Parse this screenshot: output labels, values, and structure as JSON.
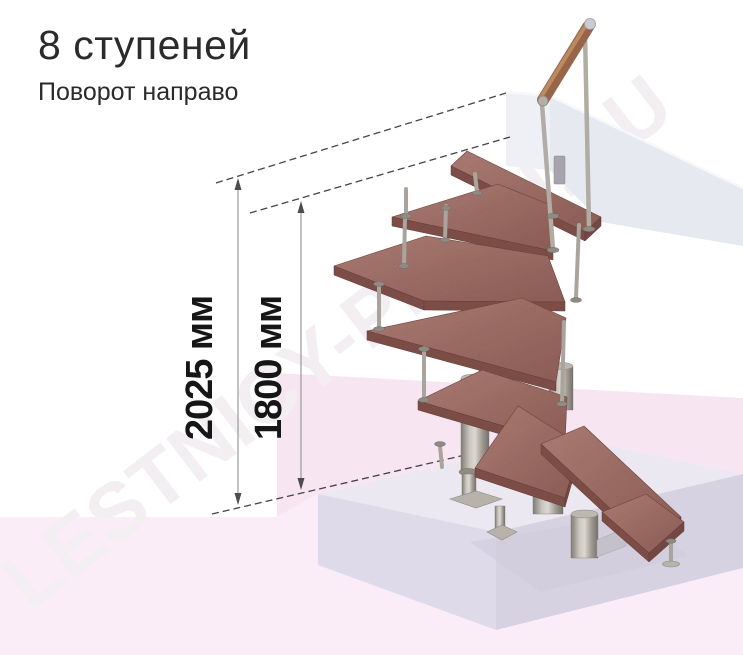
{
  "header": {
    "title": "8 ступеней",
    "subtitle": "Поворот направо"
  },
  "dimensions": {
    "overall": {
      "label": "2025 мм"
    },
    "to_top_step": {
      "label": "1800 мм"
    }
  },
  "watermark": {
    "text": "LESTNICY-PROFI.RU"
  },
  "product": {
    "steps_count": "8",
    "turn_direction": "направо",
    "type": "модульная лестница с поворотом"
  },
  "colors": {
    "tread_wood": "#9c6d66",
    "tread_edge": "#7c4d47",
    "metal": "#a8a49c",
    "handrail_wood": "#96654a",
    "floor_pink": "#faedf7",
    "platform_slab": "#ebe8f2",
    "landing_slab": "#e7e9f1",
    "dimension_text": "#161616"
  }
}
